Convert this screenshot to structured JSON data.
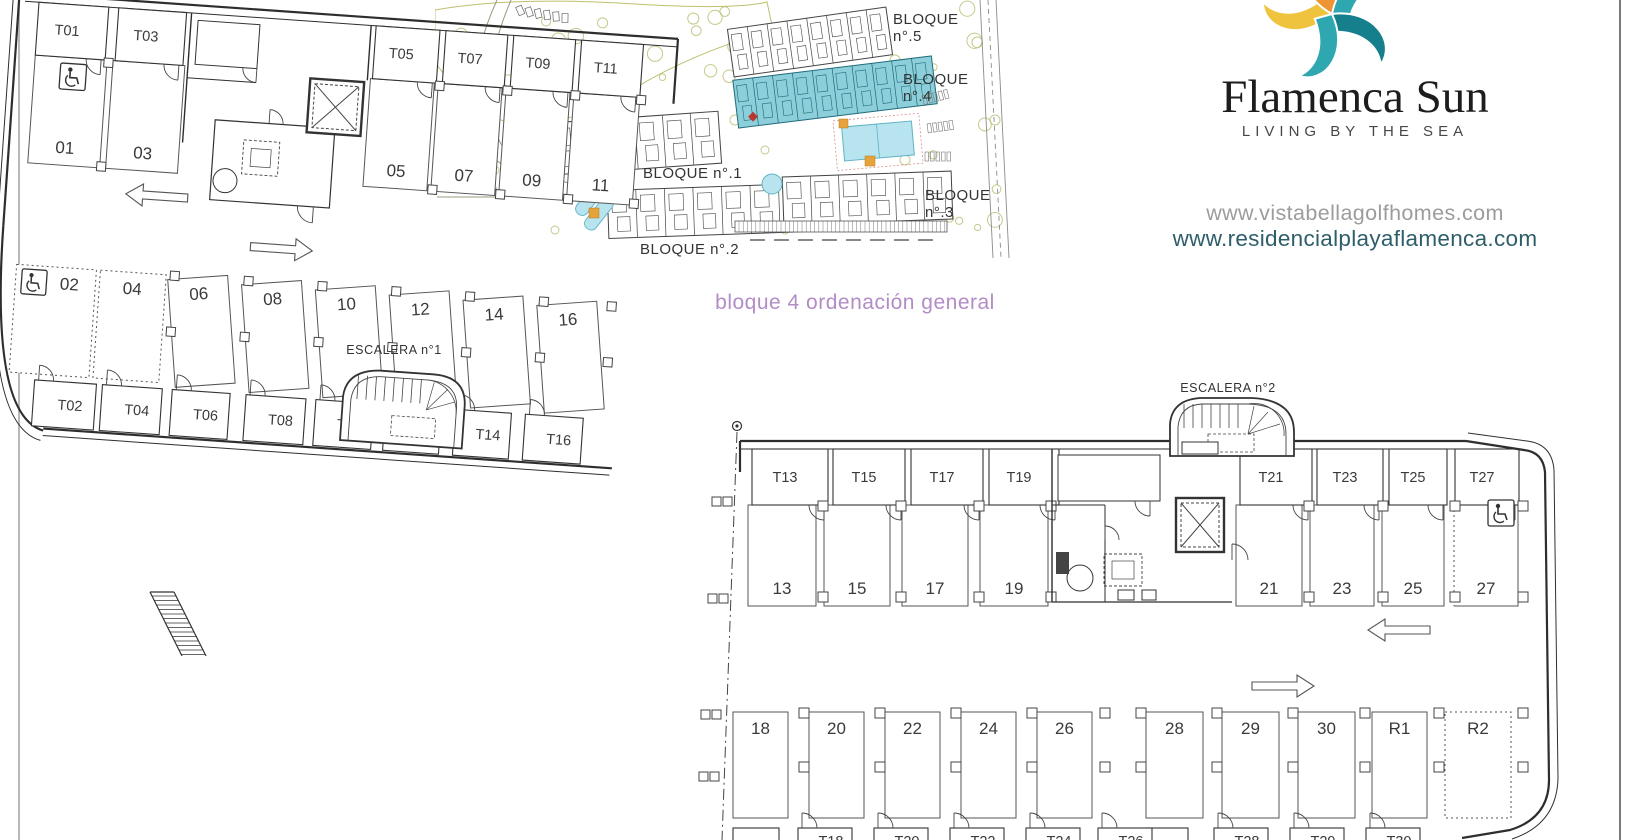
{
  "branding": {
    "name": "Flamenca Sun",
    "tagline": "LIVING BY THE SEA",
    "url_primary": "www.vistabellagolfhomes.com",
    "url_secondary": "www.residencialplayaflamenca.com",
    "logo_colors": {
      "yellow": "#f0c33f",
      "orange": "#ee9433",
      "teal": "#2fa7b1",
      "dark_teal": "#15808b"
    }
  },
  "title": {
    "text": "bloque 4 ordenación general",
    "color": "#b28cc6"
  },
  "site_plan": {
    "highlight_color": "#8ccfdb",
    "labels": [
      {
        "id": "bloque-5",
        "lines": [
          "BLOQUE",
          "n°.5"
        ]
      },
      {
        "id": "bloque-4",
        "lines": [
          "BLOQUE",
          "n°.4"
        ]
      },
      {
        "id": "bloque-1",
        "lines": [
          "BLOQUE n°.1"
        ]
      },
      {
        "id": "bloque-2",
        "lines": [
          "BLOQUE n°.2"
        ]
      },
      {
        "id": "bloque-3",
        "lines": [
          "BLOQUE",
          "n°.3"
        ]
      }
    ]
  },
  "floor_plan": {
    "escalera1": "ESCALERA n°1",
    "escalera2": "ESCALERA n°2",
    "left_wing": {
      "top_storage": [
        "T01",
        "T03",
        "T05",
        "T07",
        "T09",
        "T11"
      ],
      "top_stalls": [
        "01",
        "03",
        "05",
        "07",
        "09",
        "11"
      ],
      "bottom_stalls": [
        "02",
        "04",
        "06",
        "08",
        "10",
        "12",
        "14",
        "16"
      ],
      "bottom_storage": [
        "T02",
        "T04",
        "T06",
        "T08",
        "T10",
        "T12",
        "T14",
        "T16"
      ]
    },
    "right_wing": {
      "top_storage": [
        "T13",
        "T15",
        "T17",
        "T19",
        "T21",
        "T23",
        "T25",
        "T27"
      ],
      "top_stalls": [
        "13",
        "15",
        "17",
        "19",
        "21",
        "23",
        "25",
        "27"
      ],
      "bottom_stalls": [
        "18",
        "20",
        "22",
        "24",
        "26",
        "28",
        "29",
        "30",
        "R1",
        "R2"
      ],
      "bottom_storage": [
        "T18",
        "T20",
        "T22",
        "T24",
        "T26",
        "T28",
        "T29",
        "T30"
      ]
    },
    "accessible_stalls": [
      "01",
      "02",
      "27"
    ],
    "reserved_dashed_stalls": [
      "02",
      "04",
      "27",
      "R2"
    ]
  }
}
